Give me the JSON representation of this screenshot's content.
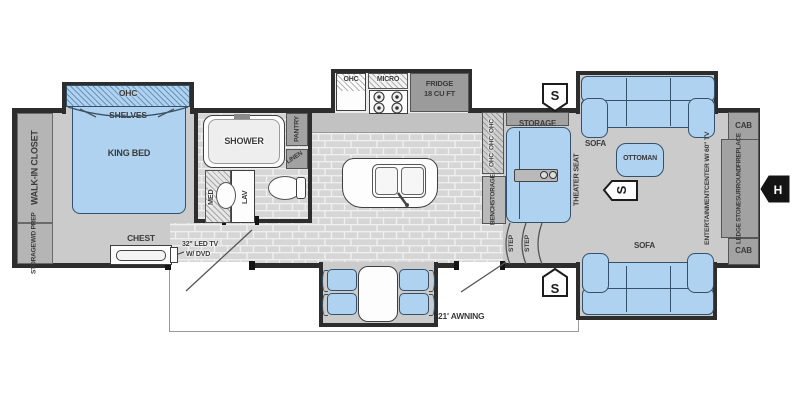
{
  "plan": {
    "bedroom": {
      "closet": "WALK-IN CLOSET",
      "storage_prep_line1": "STORAGE",
      "storage_prep_line2": "W/D PREP",
      "ohc": "OHC",
      "shelves": "SHELVES",
      "bed": "KING BED",
      "chest": "CHEST",
      "tv_line1": "32\" LED TV",
      "tv_line2": "W/ DVD"
    },
    "bath": {
      "shower": "SHOWER",
      "pantry": "PANTRY",
      "linen": "LINEN",
      "med": "MED",
      "lav": "LAV"
    },
    "kitchen": {
      "ohc": "OHC",
      "micro": "MICRO",
      "fridge_line1": "FRIDGE",
      "fridge_line2": "18 CU FT",
      "storage": "STORAGE",
      "bench_line1": "BENCH",
      "bench_line2": "STORAGE"
    },
    "living": {
      "theater_seat": "THEATER SEAT",
      "sofa": "SOFA",
      "ottoman": "OTTOMAN",
      "cab": "CAB",
      "ent_line1": "ENTERTAINMENT",
      "ent_line2": "CENTER W/ 60\" TV",
      "fp_line1": "LEDGE STONE",
      "fp_line2": "SURROUND",
      "fp_line3": "FIREPLACE",
      "step": "STEP"
    },
    "exterior": {
      "awning": "21' AWNING"
    },
    "markers": {
      "speaker": "S",
      "hookup": "H"
    }
  },
  "colors": {
    "wall": "#2d2d2d",
    "floor": "#cbcbcb",
    "furniture_blue": "#aed2ef",
    "cabinet_gray": "#a2a2a2",
    "tile": "#d6d6d6",
    "marker_black": "#141414"
  }
}
